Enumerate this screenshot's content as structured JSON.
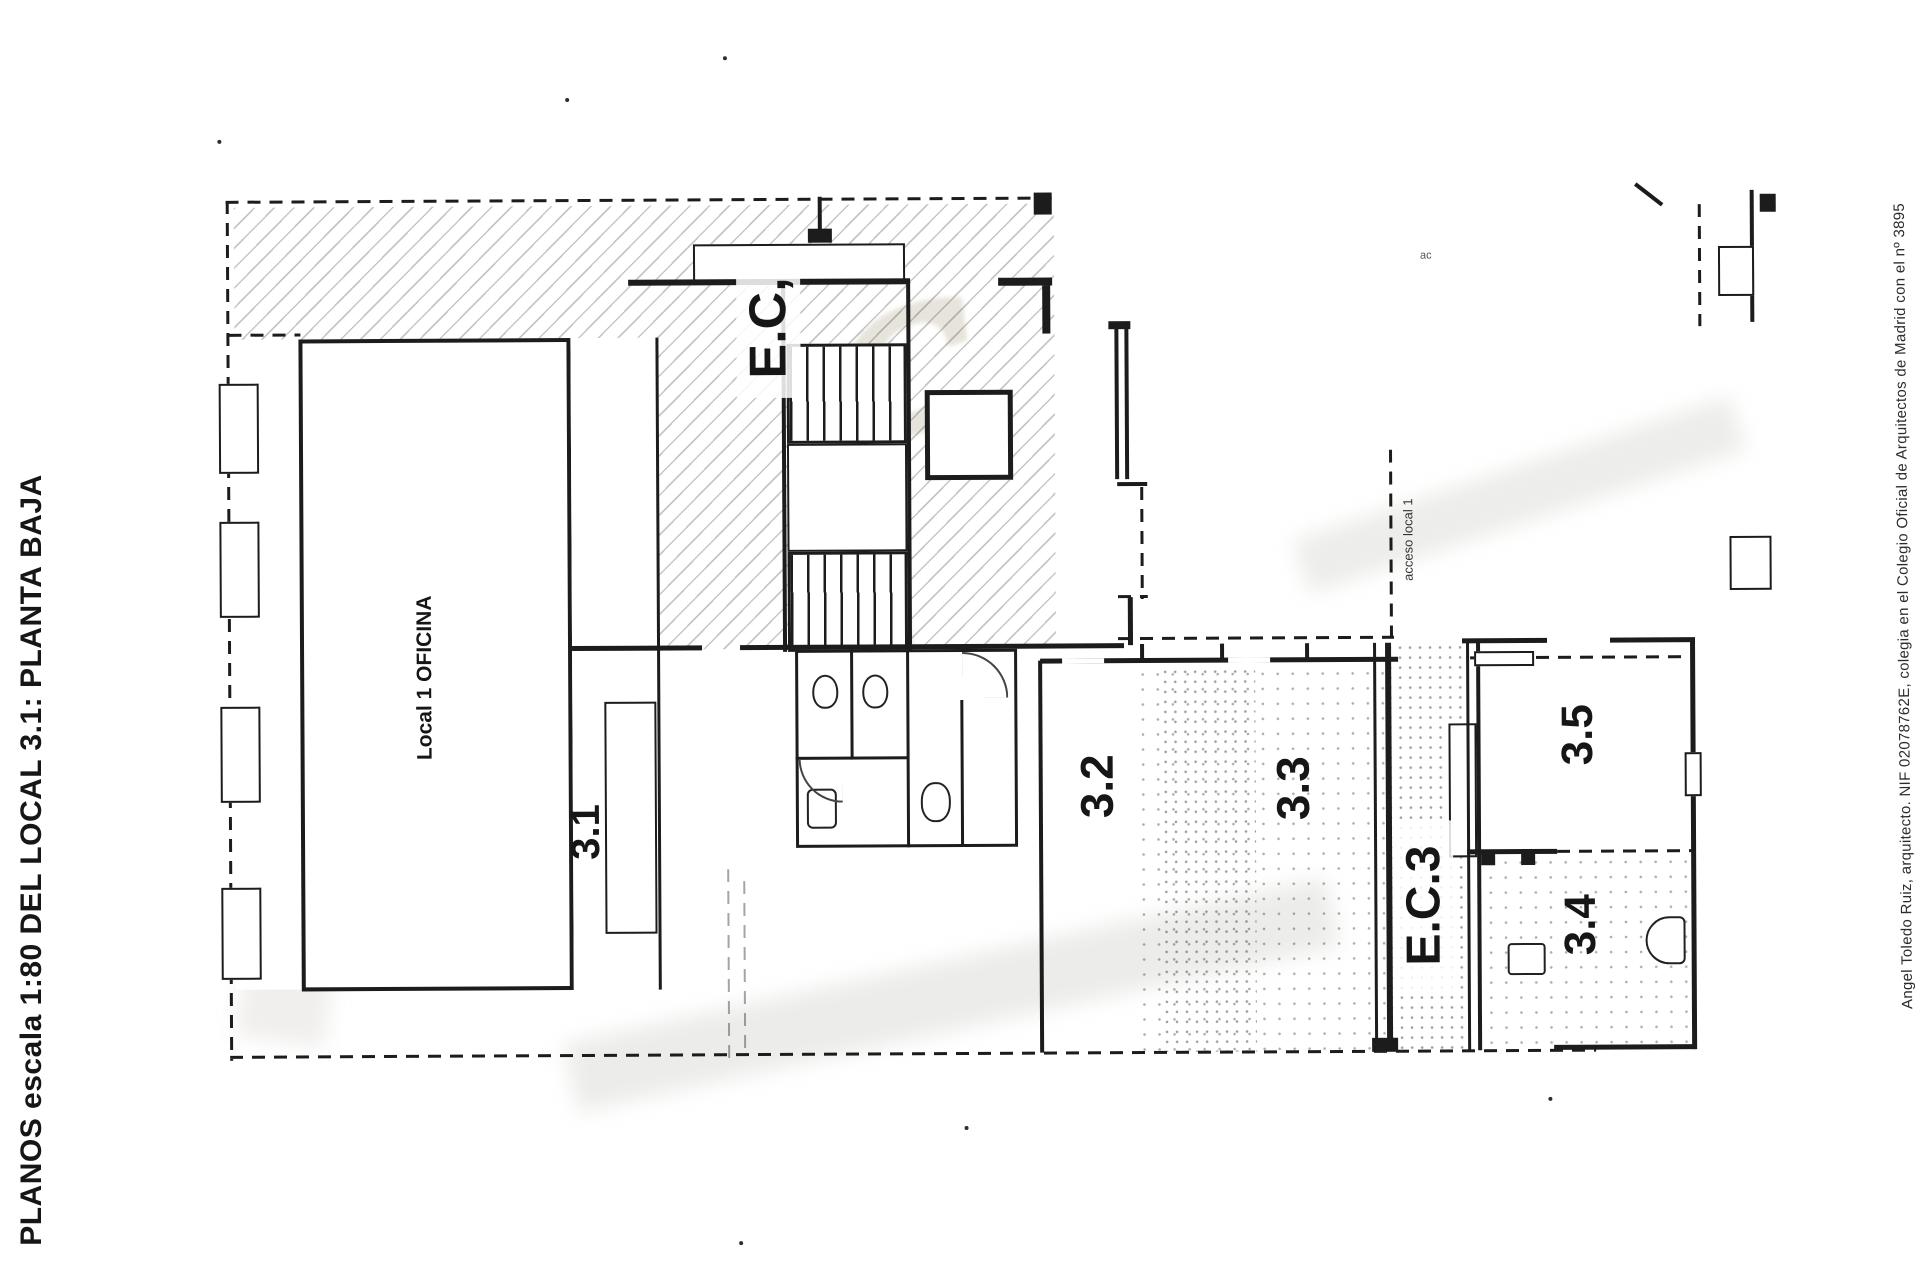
{
  "document": {
    "side_title": "PLANOS escala 1:80  DEL LOCAL 3.1: PLANTA BAJA",
    "attribution": "Angel Toledo Ruiz, arquitecto. NIF 02078762E, colegia en el Colegio Oficial de Arquitectos de Madrid con el nº 3895"
  },
  "plan": {
    "labels": {
      "office": "Local 1 OFICINA",
      "zone_3_1": "3.1",
      "stair_core": "E.C,",
      "zone_3_2": "3.2",
      "zone_3_3": "3.3",
      "stair_core_3": "E.C.3",
      "zone_3_4": "3.4",
      "zone_3_5": "3.5",
      "access_note": "acceso local 1",
      "tiny_note": "ac"
    },
    "colors": {
      "ink": "#1c1c1c",
      "paper": "#ffffff",
      "watermark": "#e6e4db"
    }
  }
}
